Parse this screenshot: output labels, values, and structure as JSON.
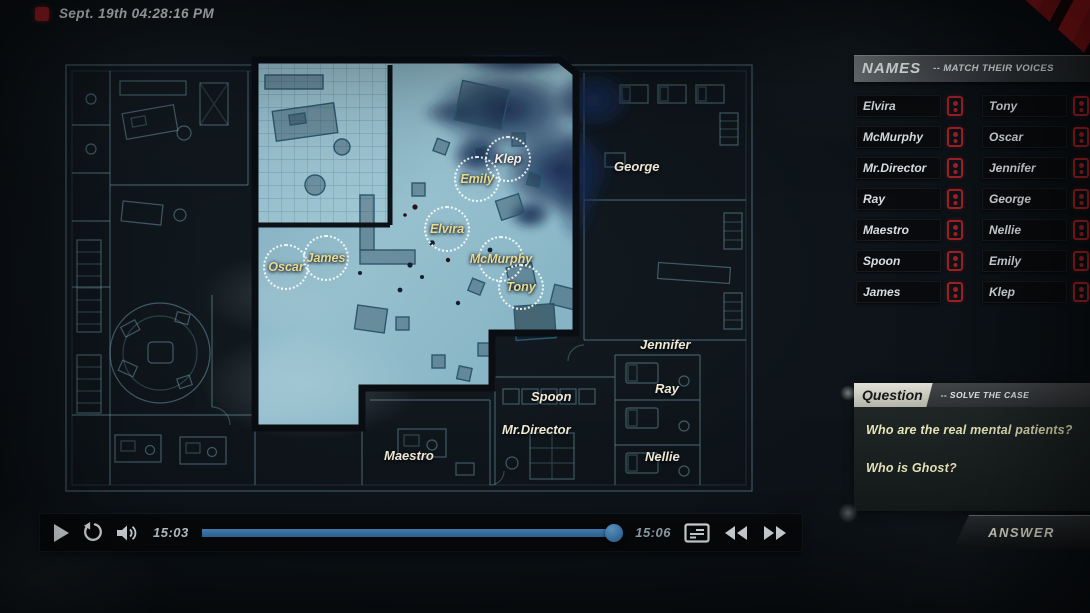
{
  "header": {
    "timestamp": "Sept. 19th 04:28:16 PM",
    "icon": "red-square-icon"
  },
  "map": {
    "markers": [
      {
        "label": "Oscar"
      },
      {
        "label": "James"
      },
      {
        "label": "Elvira"
      },
      {
        "label": "Emily"
      },
      {
        "label": "Klep"
      },
      {
        "label": "McMurphy"
      },
      {
        "label": "Tony"
      }
    ],
    "room_labels": [
      {
        "label": "George"
      },
      {
        "label": "Jennifer"
      },
      {
        "label": "Ray"
      },
      {
        "label": "Nellie"
      },
      {
        "label": "Spoon"
      },
      {
        "label": "Mr.Director"
      },
      {
        "label": "Maestro"
      }
    ]
  },
  "names_panel": {
    "title": "NAMES",
    "subtitle": "-- MATCH THEIR VOICES",
    "slot_icon": "voice-slot-icon",
    "rows": [
      {
        "left": "Elvira",
        "right": "Tony"
      },
      {
        "left": "McMurphy",
        "right": "Oscar"
      },
      {
        "left": "Mr.Director",
        "right": "Jennifer"
      },
      {
        "left": "Ray",
        "right": "George"
      },
      {
        "left": "Maestro",
        "right": "Nellie"
      },
      {
        "left": "Spoon",
        "right": "Emily"
      },
      {
        "left": "James",
        "right": "Klep"
      }
    ]
  },
  "question_panel": {
    "title": "Question",
    "subtitle": "-- SOLVE THE CASE",
    "questions": [
      "Who are the real mental patients?",
      "Who is Ghost?"
    ],
    "answer_label": "ANSWER"
  },
  "player": {
    "elapsed": "15:03",
    "total": "15:06",
    "progress_pct": 98,
    "icons": [
      "play-icon",
      "restart-icon",
      "volume-icon",
      "transcript-icon",
      "rewind-icon",
      "fast-forward-icon"
    ]
  },
  "colors": {
    "accent_red": "#a32025",
    "progress_blue": "#3f81b8",
    "map_label_yellow": "#e9da8e",
    "room_label_cream": "#efe9d2",
    "blueprint_teal": "#7fb0c2"
  }
}
